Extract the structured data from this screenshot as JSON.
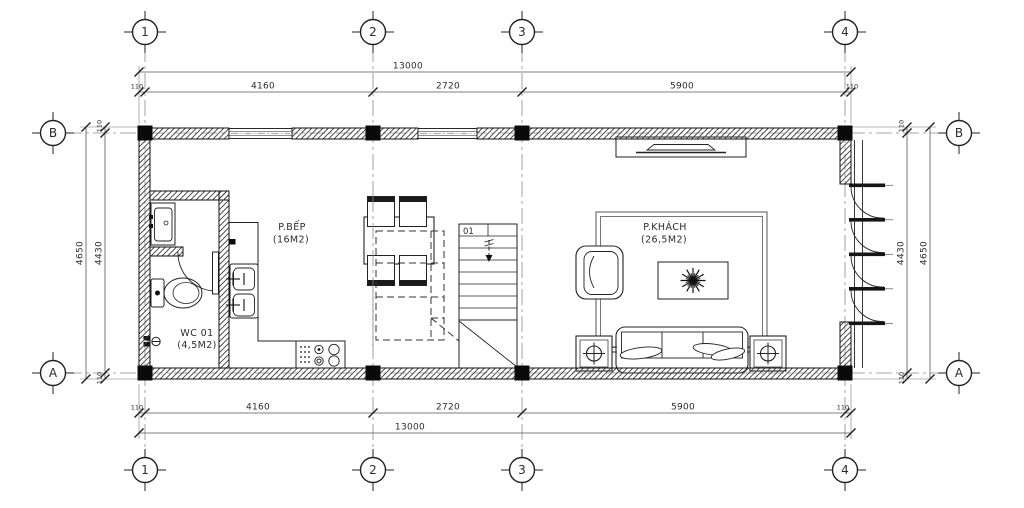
{
  "drawing_type": "floor-plan",
  "grid": {
    "cols": [
      "1",
      "2",
      "3",
      "4"
    ],
    "rows": [
      "B",
      "A"
    ]
  },
  "dims": {
    "total": "13000",
    "segments": [
      "110",
      "4160",
      "2720",
      "5900",
      "110"
    ],
    "side_total": "4650",
    "side_inner": "4430",
    "side_end": "110"
  },
  "rooms": {
    "wc": {
      "name": "WC 01",
      "area": "(4,5M2)"
    },
    "kitchen": {
      "name": "P.BẾP",
      "area": "(16M2)"
    },
    "living": {
      "name": "P.KHÁCH",
      "area": "(26,5M2)"
    }
  },
  "stairs": {
    "label": "01"
  },
  "colors": {
    "line": "#222222",
    "dim": "#555555",
    "hatch": "#3c3c3c",
    "background": "#ffffff"
  }
}
